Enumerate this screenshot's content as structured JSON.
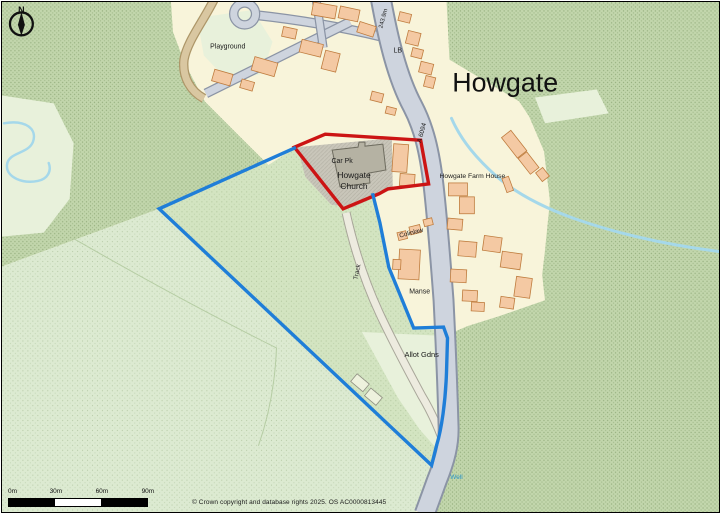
{
  "map": {
    "title": "Howgate",
    "north_label": "N",
    "copyright": "© Crown copyright and database rights 2025. OS AC0000813445",
    "scale_bar": {
      "ticks": [
        "0m",
        "30m",
        "60m",
        "90m"
      ]
    },
    "colors": {
      "cream": "#f8f4da",
      "green_dark": "#c2d6ac",
      "green_field": "#d3e4c1",
      "green_pale": "#dcead1",
      "green_paler": "#e8f1db",
      "building": "#f4c9a3",
      "building_stroke": "#bf7c3e",
      "shed_fill": "#eef2dd",
      "shed_stroke": "#8f8f82",
      "road_fill": "#ced4de",
      "road_casing": "#8b94a5",
      "tan_fill": "#d9c7a1",
      "tan_casing": "#ad9668",
      "grey_yard": "#c9c6ba",
      "grey_building": "#b5b2a3",
      "grey_building_stroke": "#6f6d60",
      "stream": "#a5d8ea",
      "track_fill": "#edebdf",
      "track_casing": "#a8a699",
      "field_line": "#b6cda4",
      "label": "#1a1a1a",
      "well_blue": "#2d97c9",
      "site_red": "#cc1414",
      "site_blue": "#1f7ed8"
    },
    "features": {
      "areas": [
        {
          "n": "woodland-top-left",
          "d": "M0,0 L170,0 L172,30 L184,62 L204,100 L238,134 L268,164 L294,148 L158,208 L0,266 Z",
          "fill": "green_dark",
          "dots": "dotsA"
        },
        {
          "n": "woodland-right",
          "d": "M447,0 L721,0 L721,513 L428,513 L438,490 L447,450 L449,390 L448,335 L460,325 L540,302 L546,250 L551,200 L545,150 L530,115 L520,100 L450,58 Z",
          "fill": "green_dark",
          "dots": "dotsA"
        },
        {
          "n": "field-bottom-left",
          "d": "M0,266 L158,208 L432,466 L424,492 L416,513 L0,513 Z",
          "fill": "green_pale",
          "dots": "dotsB"
        },
        {
          "n": "site-field",
          "d": "M294,147 L158,208 L432,466 L437,446 L446,400 L448,338 L444,327 L414,328 L389,267 L380,222 L373,194 L343,208 Z",
          "fill": "green_field",
          "dots": "dotsB"
        },
        {
          "n": "pale-field-left-edge",
          "d": "M0,94 L52,102 L72,142 L68,198 L42,232 L0,236 Z",
          "fill": "green_paler"
        },
        {
          "n": "village-north",
          "d": "M170,0 L447,0 L449,45 L441,90 L448,120 L442,133 L300,143 L268,164 L238,134 L204,100 L184,62 L172,30 Z",
          "fill": "cream"
        },
        {
          "n": "farm-plots-east",
          "d": "M438,90 L520,117 L543,155 L549,210 L541,255 L546,300 L500,316 L468,326 L452,333 L443,300 L439,230 L435,160 Z",
          "fill": "cream"
        },
        {
          "n": "manse-plots-west",
          "d": "M300,143 L435,133 L439,230 L443,300 L448,330 L414,329 L389,267 L380,222 L373,194 L352,207 L331,204 L305,176 Z",
          "fill": "cream"
        },
        {
          "n": "playground-area",
          "d": "M196,16 L252,8 L272,40 L262,72 L228,80 L203,54 Z",
          "fill": "green_paler"
        },
        {
          "n": "pale-field-northeast",
          "d": "M536,96 L598,88 L610,112 L546,122 Z",
          "fill": "green_paler"
        },
        {
          "n": "allotment-gardens",
          "d": "M362,332 L446,336 L448,428 L436,448 L420,430 L398,398 L374,354 Z",
          "fill": "green_paler"
        },
        {
          "n": "churchyard",
          "d": "M297,146 L392,137 L393,188 L352,207 L331,204 L305,176 Z",
          "fill": "grey_yard",
          "dots": "hatch"
        }
      ],
      "lines": [
        {
          "n": "field-boundary-1",
          "d": "M72,238 Q180,300 276,348",
          "stroke": "field_line",
          "w": 1
        },
        {
          "n": "field-boundary-2",
          "d": "M276,348 Q274,400 258,446",
          "stroke": "field_line",
          "w": 1
        },
        {
          "n": "stream-west",
          "d": "M2,122 C24,118 36,128 31,141 C26,153 6,151 5,164 C4,177 22,183 36,180 C46,178 50,170 47,162",
          "stroke": "stream",
          "w": 2.5
        },
        {
          "n": "stream-east",
          "d": "M452,117 C462,140 478,158 498,176 C518,193 545,207 576,218 C616,232 666,244 721,251",
          "stroke": "stream",
          "w": 3
        }
      ],
      "roads": [
        {
          "n": "lane-playground",
          "d": "M213,-2 C202,20 186,40 183,58 C181,76 190,90 203,97",
          "ck": "tan_casing",
          "cw": 9.5,
          "fk": "tan_fill",
          "w": 7
        },
        {
          "n": "street-upper",
          "d": "M254,13 C300,18 345,26 382,35",
          "ck": "road_casing",
          "cw": 10,
          "fk": "road_fill",
          "w": 7.5
        },
        {
          "n": "street-diagonal",
          "d": "M350,20 L205,92",
          "ck": "road_casing",
          "cw": 10,
          "fk": "road_fill",
          "w": 7.5
        },
        {
          "n": "street-short",
          "d": "M316,-2 L323,46",
          "ck": "road_casing",
          "cw": 9,
          "fk": "road_fill",
          "w": 6.5
        },
        {
          "n": "track-south",
          "d": "M346,212 C354,248 366,284 380,314 C394,344 408,370 422,396 C434,416 442,436 448,454",
          "ck": "track_casing",
          "cw": 9,
          "fk": "track_fill",
          "w": 7
        },
        {
          "n": "road-a6094",
          "d": "M381,-3 C388,35 397,75 413,105 C424,126 430,150 434,185 C438,220 441,260 444,300 C446,340 448,390 449,425 C450,445 445,462 437,482 C433,493 428,507 425,515",
          "ck": "road_casing",
          "cw": 22,
          "fk": "road_fill",
          "w": 18
        }
      ],
      "loop": {
        "n": "cul-de-sac-loop",
        "cx": 244,
        "cy": 12,
        "r": 11,
        "ck": "road_casing",
        "cw": 9.5,
        "fk": "road_fill",
        "w": 7
      },
      "church_building": {
        "n": "howgate-church-building",
        "d": "M332,149 L358,146 L359,141 L365,141 L365,145 L383,143 L386,169 L369,172 L370,182 L340,186 Z",
        "fill": "grey_building",
        "stroke": "grey_building_stroke"
      },
      "buildings": [
        [
          312,
          2,
          24,
          13,
          10
        ],
        [
          339,
          6,
          20,
          12,
          12
        ],
        [
          358,
          22,
          17,
          11,
          18
        ],
        [
          300,
          40,
          22,
          13,
          14
        ],
        [
          323,
          50,
          15,
          19,
          14
        ],
        [
          252,
          58,
          24,
          14,
          16
        ],
        [
          212,
          70,
          19,
          12,
          16
        ],
        [
          240,
          79,
          13,
          9,
          16
        ],
        [
          282,
          26,
          14,
          10,
          12
        ],
        [
          399,
          11,
          12,
          9,
          14
        ],
        [
          407,
          30,
          13,
          13,
          14
        ],
        [
          412,
          47,
          11,
          9,
          14
        ],
        [
          420,
          61,
          13,
          11,
          14
        ],
        [
          425,
          75,
          10,
          11,
          14
        ],
        [
          371,
          91,
          12,
          9,
          14
        ],
        [
          386,
          106,
          10,
          7,
          14
        ],
        [
          393,
          143,
          15,
          28,
          4
        ],
        [
          400,
          173,
          15,
          12,
          4
        ],
        [
          509,
          130,
          12,
          26,
          -38
        ],
        [
          524,
          152,
          11,
          20,
          -38
        ],
        [
          539,
          168,
          9,
          11,
          -38
        ],
        [
          449,
          182,
          19,
          13,
          0
        ],
        [
          460,
          196,
          15,
          17,
          0
        ],
        [
          505,
          176,
          7,
          15,
          -20
        ],
        [
          448,
          218,
          15,
          11,
          5
        ],
        [
          459,
          241,
          18,
          15,
          5
        ],
        [
          451,
          269,
          16,
          13,
          3
        ],
        [
          463,
          290,
          15,
          11,
          3
        ],
        [
          472,
          302,
          13,
          9,
          3
        ],
        [
          484,
          236,
          18,
          15,
          8
        ],
        [
          502,
          252,
          20,
          16,
          8
        ],
        [
          516,
          277,
          16,
          20,
          8
        ],
        [
          501,
          297,
          14,
          11,
          8
        ],
        [
          398,
          231,
          9,
          8,
          -14
        ],
        [
          410,
          225,
          11,
          8,
          -14
        ],
        [
          424,
          218,
          9,
          7,
          -14
        ],
        [
          399,
          249,
          21,
          30,
          3
        ],
        [
          393,
          259,
          8,
          10,
          3
        ],
        [
          352,
          378,
          16,
          10,
          40,
          "shed"
        ],
        [
          366,
          392,
          15,
          10,
          40,
          "shed"
        ]
      ],
      "boundaries": [
        {
          "n": "site-outline-red",
          "d": "M294,146 L325,133 L421,139 L429,183 L388,188 L379,193 L343,208 Z",
          "color": "site_red",
          "w": 3.4
        },
        {
          "n": "site-outline-blue",
          "d": "M294,147 L158,208 L432,466 L437,446 C442,430 446,402 447,372 L448,338 L444,327 L414,328 L389,267 L380,222 L373,194",
          "color": "site_blue",
          "w": 3.4
        }
      ]
    },
    "labels": [
      {
        "n": "title-howgate",
        "t": "Howgate",
        "x": 506,
        "y": 90,
        "s": 27,
        "r": 0,
        "c": "#111111"
      },
      {
        "n": "label-playground",
        "t": "Playground",
        "x": 227,
        "y": 47,
        "s": 7,
        "r": 0,
        "c": "#1a1a1a"
      },
      {
        "n": "label-car-pk",
        "t": "Car Pk",
        "x": 342,
        "y": 162,
        "s": 7,
        "r": 0,
        "c": "#1a1a1a"
      },
      {
        "n": "label-howgate-church-1",
        "t": "Howgate",
        "x": 354,
        "y": 177,
        "s": 8.5,
        "r": 0,
        "c": "#1a1a1a"
      },
      {
        "n": "label-howgate-church-2",
        "t": "Church",
        "x": 354,
        "y": 188,
        "s": 8.5,
        "r": 0,
        "c": "#1a1a1a"
      },
      {
        "n": "label-howgate-farm-house",
        "t": "Howgate Farm House",
        "x": 473,
        "y": 177,
        "s": 6.8,
        "r": 0,
        "c": "#1a1a1a"
      },
      {
        "n": "label-colinlaw",
        "t": "Colinlaw",
        "x": 412,
        "y": 234,
        "s": 6.5,
        "r": -14,
        "c": "#1a1a1a"
      },
      {
        "n": "label-manse",
        "t": "Manse",
        "x": 420,
        "y": 293,
        "s": 7,
        "r": 0,
        "c": "#1a1a1a"
      },
      {
        "n": "label-allot-gdns",
        "t": "Allot Gdns",
        "x": 422,
        "y": 357,
        "s": 7.5,
        "r": 0,
        "c": "#1a1a1a"
      },
      {
        "n": "label-track",
        "t": "Track",
        "x": 359,
        "y": 272,
        "s": 6.5,
        "r": -78,
        "c": "#333333"
      },
      {
        "n": "label-lb",
        "t": "LB",
        "x": 398,
        "y": 51,
        "s": 7,
        "r": 0,
        "c": "#1a1a1a"
      },
      {
        "n": "label-a6094",
        "t": "A 6094",
        "x": 424,
        "y": 132,
        "s": 6.5,
        "r": -75,
        "c": "#1a1a1a"
      },
      {
        "n": "label-spot-height",
        "t": "243.9m",
        "x": 385,
        "y": 17,
        "s": 6,
        "r": -75,
        "c": "#1a1a1a"
      },
      {
        "n": "label-well",
        "t": "Well",
        "x": 457,
        "y": 480,
        "s": 6.5,
        "r": 0,
        "c": "#2d97c9"
      }
    ]
  }
}
